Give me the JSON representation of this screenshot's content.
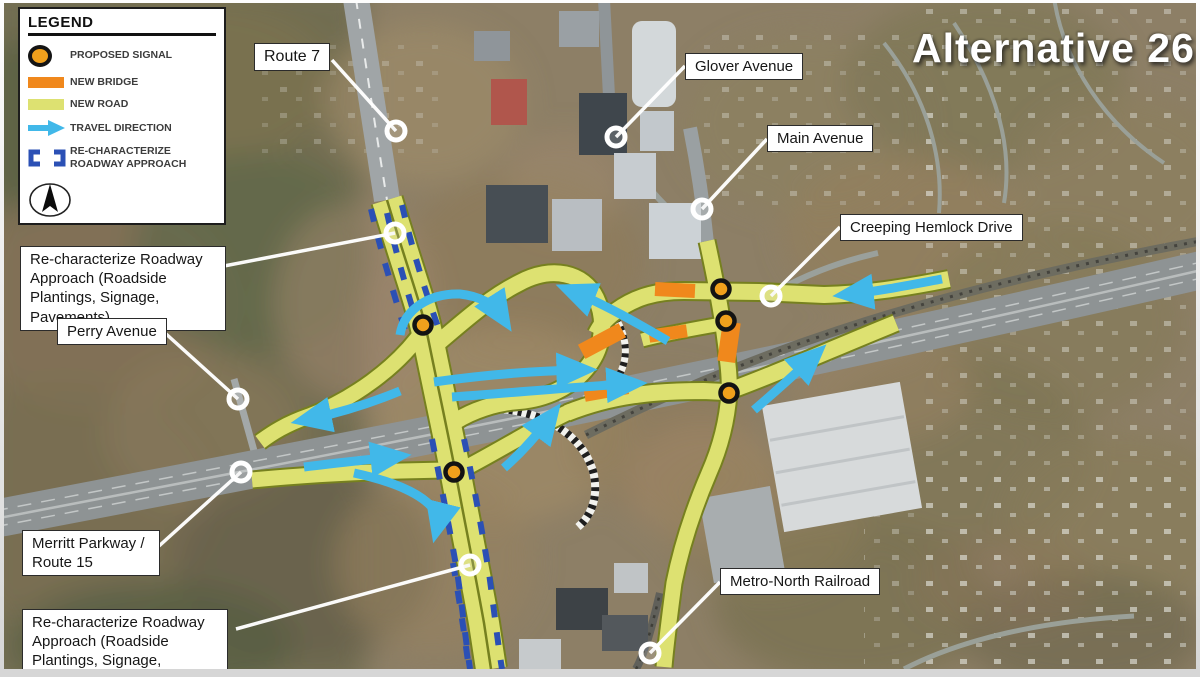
{
  "title": "Alternative 26",
  "legend": {
    "title": "LEGEND",
    "items": [
      {
        "icon": "proposed-signal-icon",
        "label": "PROPOSED SIGNAL"
      },
      {
        "icon": "new-bridge-icon",
        "label": "NEW BRIDGE"
      },
      {
        "icon": "new-road-icon",
        "label": "NEW ROAD"
      },
      {
        "icon": "travel-direction-icon",
        "label": "TRAVEL DIRECTION"
      },
      {
        "icon": "re-characterize-icon",
        "label": "RE-CHARACTERIZE ROADWAY APPROACH"
      }
    ],
    "north_arrow": "north-compass"
  },
  "callouts": {
    "route7": "Route 7",
    "glover": "Glover Avenue",
    "main": "Main Avenue",
    "creeping": "Creeping Hemlock Drive",
    "rechar_top": "Re-characterize Roadway Approach (Roadside Plantings, Signage, Pavements)",
    "perry": "Perry Avenue",
    "merritt": "Merritt Parkway / Route 15",
    "rechar_bottom": "Re-characterize Roadway Approach (Roadside Plantings, Signage, Pavements)",
    "metro": "Metro-North Railroad"
  },
  "map": {
    "proposed_signals_count": 5,
    "colors": {
      "new_road": "#dde171",
      "new_bridge": "#f0881c",
      "travel_direction": "#41b8e9",
      "re_characterize": "#2b50b5",
      "signal_fill": "#f0a01c"
    }
  }
}
